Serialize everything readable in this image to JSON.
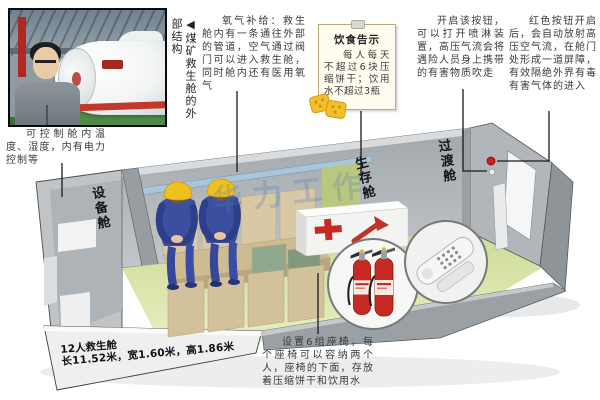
{
  "photo_caption": "◀煤矿救生舱的外部结构",
  "callouts": {
    "control": "可控制舱内温度、湿度，内有电力控制等",
    "oxygen": "氧气补给：救生舱内有一条通往外部的管道，空气通过阀门可以进入救生舱，同时舱内还有医用氧气",
    "spray": "开启该按钮，可以打开喷淋装置，高压气流会将遇险人员身上携带的有害物质吹走",
    "red_button": "红色按钮开启后，会自动放射高压空气流，在舱门处形成一道屏障，有效隔绝外界有毒有害气体的进入",
    "seats": "设置6组座椅，每个座椅可以容纳两个人，座椅的下面，存放着压缩饼干和饮用水"
  },
  "notice": {
    "title": "饮食告示",
    "body": "每人每天不超过6块压缩饼干；饮用水不超过3瓶"
  },
  "cabin_labels": {
    "equipment": "设备舱",
    "survival": "生存舱",
    "transition": "过渡舱"
  },
  "specs": {
    "line1": "12人救生舱",
    "line2": "长11.52米，宽1.60米，高1.86米"
  },
  "watermark": "华力工作",
  "colors": {
    "wall_gray": "#b3b8bc",
    "floor_green": "#dce8ae",
    "seat_tan": "#d6c49e",
    "accent_red": "#c62a22",
    "helmet_yellow": "#eec11f",
    "note_bg": "#fffdf0",
    "pipe_blue": "#a9c6da"
  }
}
